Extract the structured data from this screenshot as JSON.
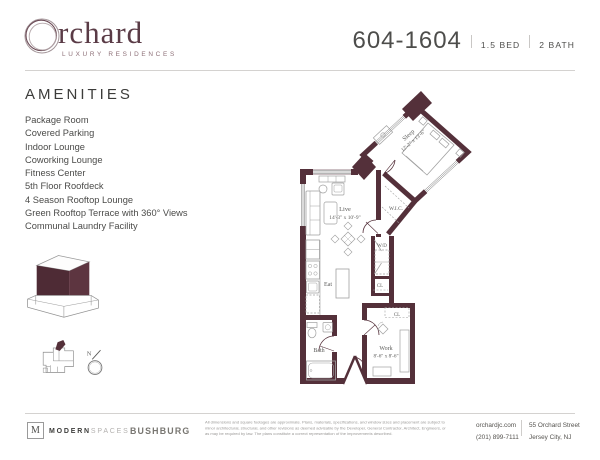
{
  "header": {
    "brand": {
      "name": "Orchard",
      "wordmark_tail": "rchard",
      "tagline": "LUXURY RESIDENCES"
    },
    "unit_number": "604-1604",
    "bed": "1.5 BED",
    "bath": "2 BATH"
  },
  "amenities": {
    "title": "AMENITIES",
    "items": [
      "Package Room",
      "Covered Parking",
      "Indoor Lounge",
      "Coworking Lounge",
      "Fitness Center",
      "5th Floor Roofdeck",
      "4 Season Rooftop Lounge",
      "Green Rooftop Terrace with 360° Views",
      "Communal Laundry Facility"
    ]
  },
  "key_plan": {
    "compass": "N"
  },
  "floor_plan": {
    "rooms": {
      "sleep": {
        "name": "Sleep",
        "dims": "12'-2\" x 13'-6\""
      },
      "live": {
        "name": "Live",
        "dims": "14'-3\" x 10'-9\""
      },
      "work": {
        "name": "Work",
        "dims": "8'-6\" x 8'-6\""
      },
      "wic": {
        "name": "W.I.C."
      },
      "washer_dryer": {
        "name": "W/D"
      },
      "closet_hall": {
        "name": "CL"
      },
      "closet_work": {
        "name": "CL"
      },
      "eat": {
        "name": "Eat"
      },
      "bath": {
        "name": "Bath"
      }
    }
  },
  "footer": {
    "brokerage": {
      "monogram": "M",
      "brand_primary": "MODERN",
      "brand_secondary": "SPACES"
    },
    "developer": "BUSHBURG",
    "disclaimer": "All dimensions and square footages are approximate. Plans, materials, specifications, and window sizes and placement are subject to minor architectural, structural, and other revisions as deemed advisable by the Developer, General Contractor, Architect, Engineers, or as may be required by law. The plans constitute a correct representation of the improvements described.",
    "website": "orchardjc.com",
    "phone": "(201) 899-7111",
    "address_line1": "55 Orchard Street",
    "address_line2": "Jersey City, NJ"
  },
  "colors": {
    "wall": "#54303a",
    "brand": "#5a3b46"
  }
}
